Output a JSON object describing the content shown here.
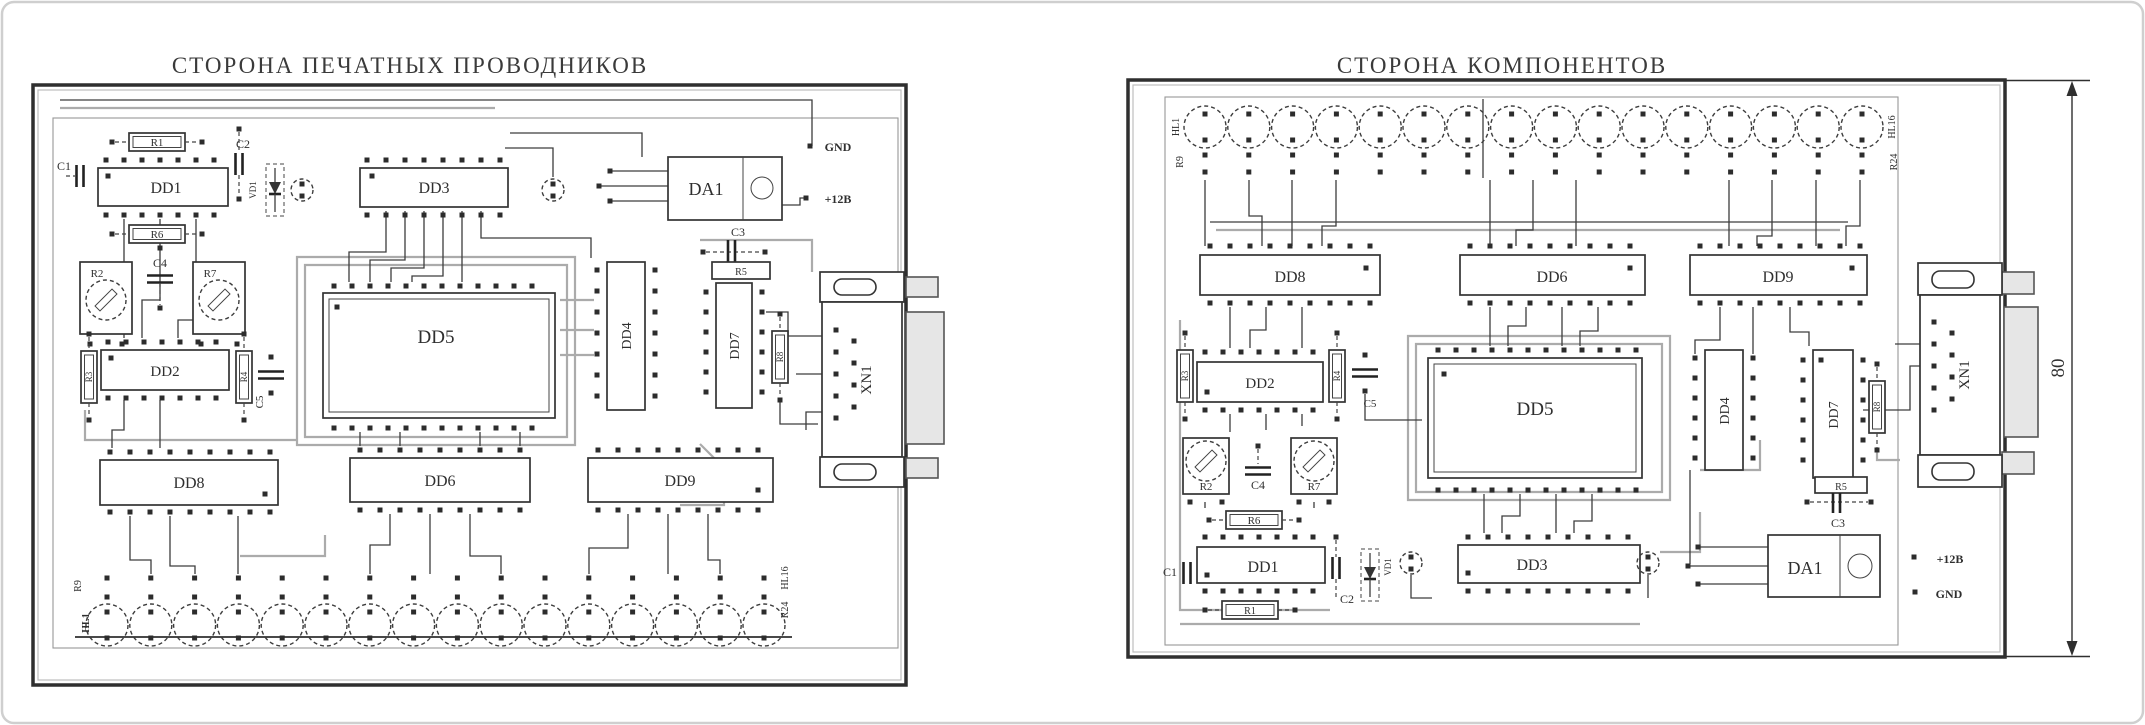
{
  "titles": {
    "left": "СТОРОНА ПЕЧАТНЫХ ПРОВОДНИКОВ",
    "right": "СТОРОНА КОМПОНЕНТОВ"
  },
  "components": {
    "dd1": "DD1",
    "dd2": "DD2",
    "dd3": "DD3",
    "dd4": "DD4",
    "dd5": "DD5",
    "dd6": "DD6",
    "dd7": "DD7",
    "dd8": "DD8",
    "dd9": "DD9",
    "da1": "DA1",
    "xn1": "XN1",
    "vd1": "VD1",
    "r1": "R1",
    "r2": "R2",
    "r3": "R3",
    "r4": "R4",
    "r5": "R5",
    "r6": "R6",
    "r7": "R7",
    "r8": "R8",
    "c1": "C1",
    "c2": "C2",
    "c3": "C3",
    "c4": "C4",
    "c5": "C5"
  },
  "power": {
    "gnd": "GND",
    "plus12": "+12В"
  },
  "led_markers": {
    "hl1": "HL1",
    "r9": "R9",
    "hl16": "HL16",
    "r24": "R24"
  },
  "dimension": {
    "board_height": "80"
  },
  "colors": {
    "ink": "#2f2f2f",
    "trace_gray": "#ababab",
    "connector_shell": "#e6e6e6"
  }
}
